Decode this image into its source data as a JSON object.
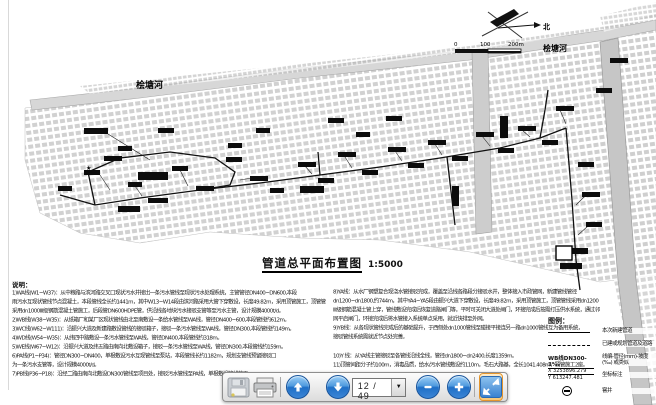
{
  "drawing": {
    "title": "管道总平面布置图",
    "scale": "1:5000",
    "north_label": "北",
    "river_label_left": "桧塘河",
    "river_label_right": "桧塘河",
    "scalebar": {
      "zero": "0",
      "mid": "100",
      "end": "200m"
    },
    "notes": {
      "heading": "说明：",
      "left": [
        "1)WA线(W1~W37)：从中粮路与滨河路交叉口现状污水井接出一条污水管线至现状污水处理系统，主管管径DN400~DN600,本段",
        "雨污水互现状管线节点混凝土，本段管线全长约1441m，其中W13~W14段由滨河路采用大管下穿敷设，长度49.82m，采用顶管施工，顶管管",
        "采用dn1000Ⅲ级钢筋混凝土管施工，后段管DN600HDPE管，供沿线各地块污水接驳支管等至污水主管，设计规模4000t/d。",
        "2)WB线(W38~W35)：从纸箱厂和某厂区现状管线由北至南敷设一条给水管线至WA线，管径DN400~600,本段管线约612m。",
        "3)WC线(W62~W111)：沿振兴大道及新建路敷设管线的接驳箱子，接驳一条污水管线至WA线，管径DN300,本段管线约149m。",
        "4)WD线(W54~W35)：从纬四中路敷设一条污水管线至WA线，管径DN400,本段管线约318m。",
        "5)WE线(W67~W12)：沿振兴大道及纬五路由南向北敷设箱子，接驳一条污水管线至WA线，管径DN300,本段管线约159m。",
        "6)PA线(P1~P34)：管径DN300~DN400，单根敷设污水互现管线至泵站，本段管线长约1182m，规划支管线预留接驳口",
        "为一条污水支管等，设计规模4000t/d。",
        "7)PB线(P36~P18)：沿经二路由南向北敷设DN300管线至项目处，接驳污水管线至PA线，单根敷设管线施工。"
      ],
      "right": [
        "8)YA线：从水厂钢塑复合现浇水管接驳完成，覆盖至沿线各路段分接驳水井，整体接入市政管网，新建管线管径",
        "dn1200~dn1800,约744m，其中YA4~YA5段由振兴大道下穿敷设，长度49.82m，采用顶管施工，顶管管线采用dn1200",
        "Ⅲ级钢筋混凝土管上穿，管线敷设完成后恢复道路闸门等，平时可关闭大道处闸门，环接完成后按需打压供水系统，通过邻",
        "网平启闸门，环接完成后将水管接入系统单点采用，就近快排至外网。",
        "9)YB线：从各现状管线完成后的基础提升，于西侧处dn1000管线至碰接平接连另一路dn1000管线互为备用系统，",
        "接驳管线系统需就近节点处完善。",
        "10)Y 线：从YA线主管接驳至各管线沿线全线，管径dn1800~dn2400,长度1359m。",
        "11)顶管间距分子约100m，消毒品质，给水/污水管线敷设约110m，毛石大路基，全长1041.408m，顶管施工2座。"
      ]
    },
    "legend": {
      "heading": "图例：",
      "new_pipe_label": "本次新建管道",
      "existing_label": "已建或规划管道及道路",
      "code_sample": "WB线DN300-3‰",
      "code_label": "线编-管径(mm)-坡度(‰) 或类似",
      "coord_x": "X 3253896.279",
      "coord_y": "Y 613247.481",
      "coord_label": "坐标标注",
      "manhole_label": "窨井"
    }
  },
  "toolbar": {
    "page_display": "12 / 49"
  },
  "colors": {
    "button_blue": "#2f7fd4",
    "highlight_orange": "#e4962e"
  }
}
